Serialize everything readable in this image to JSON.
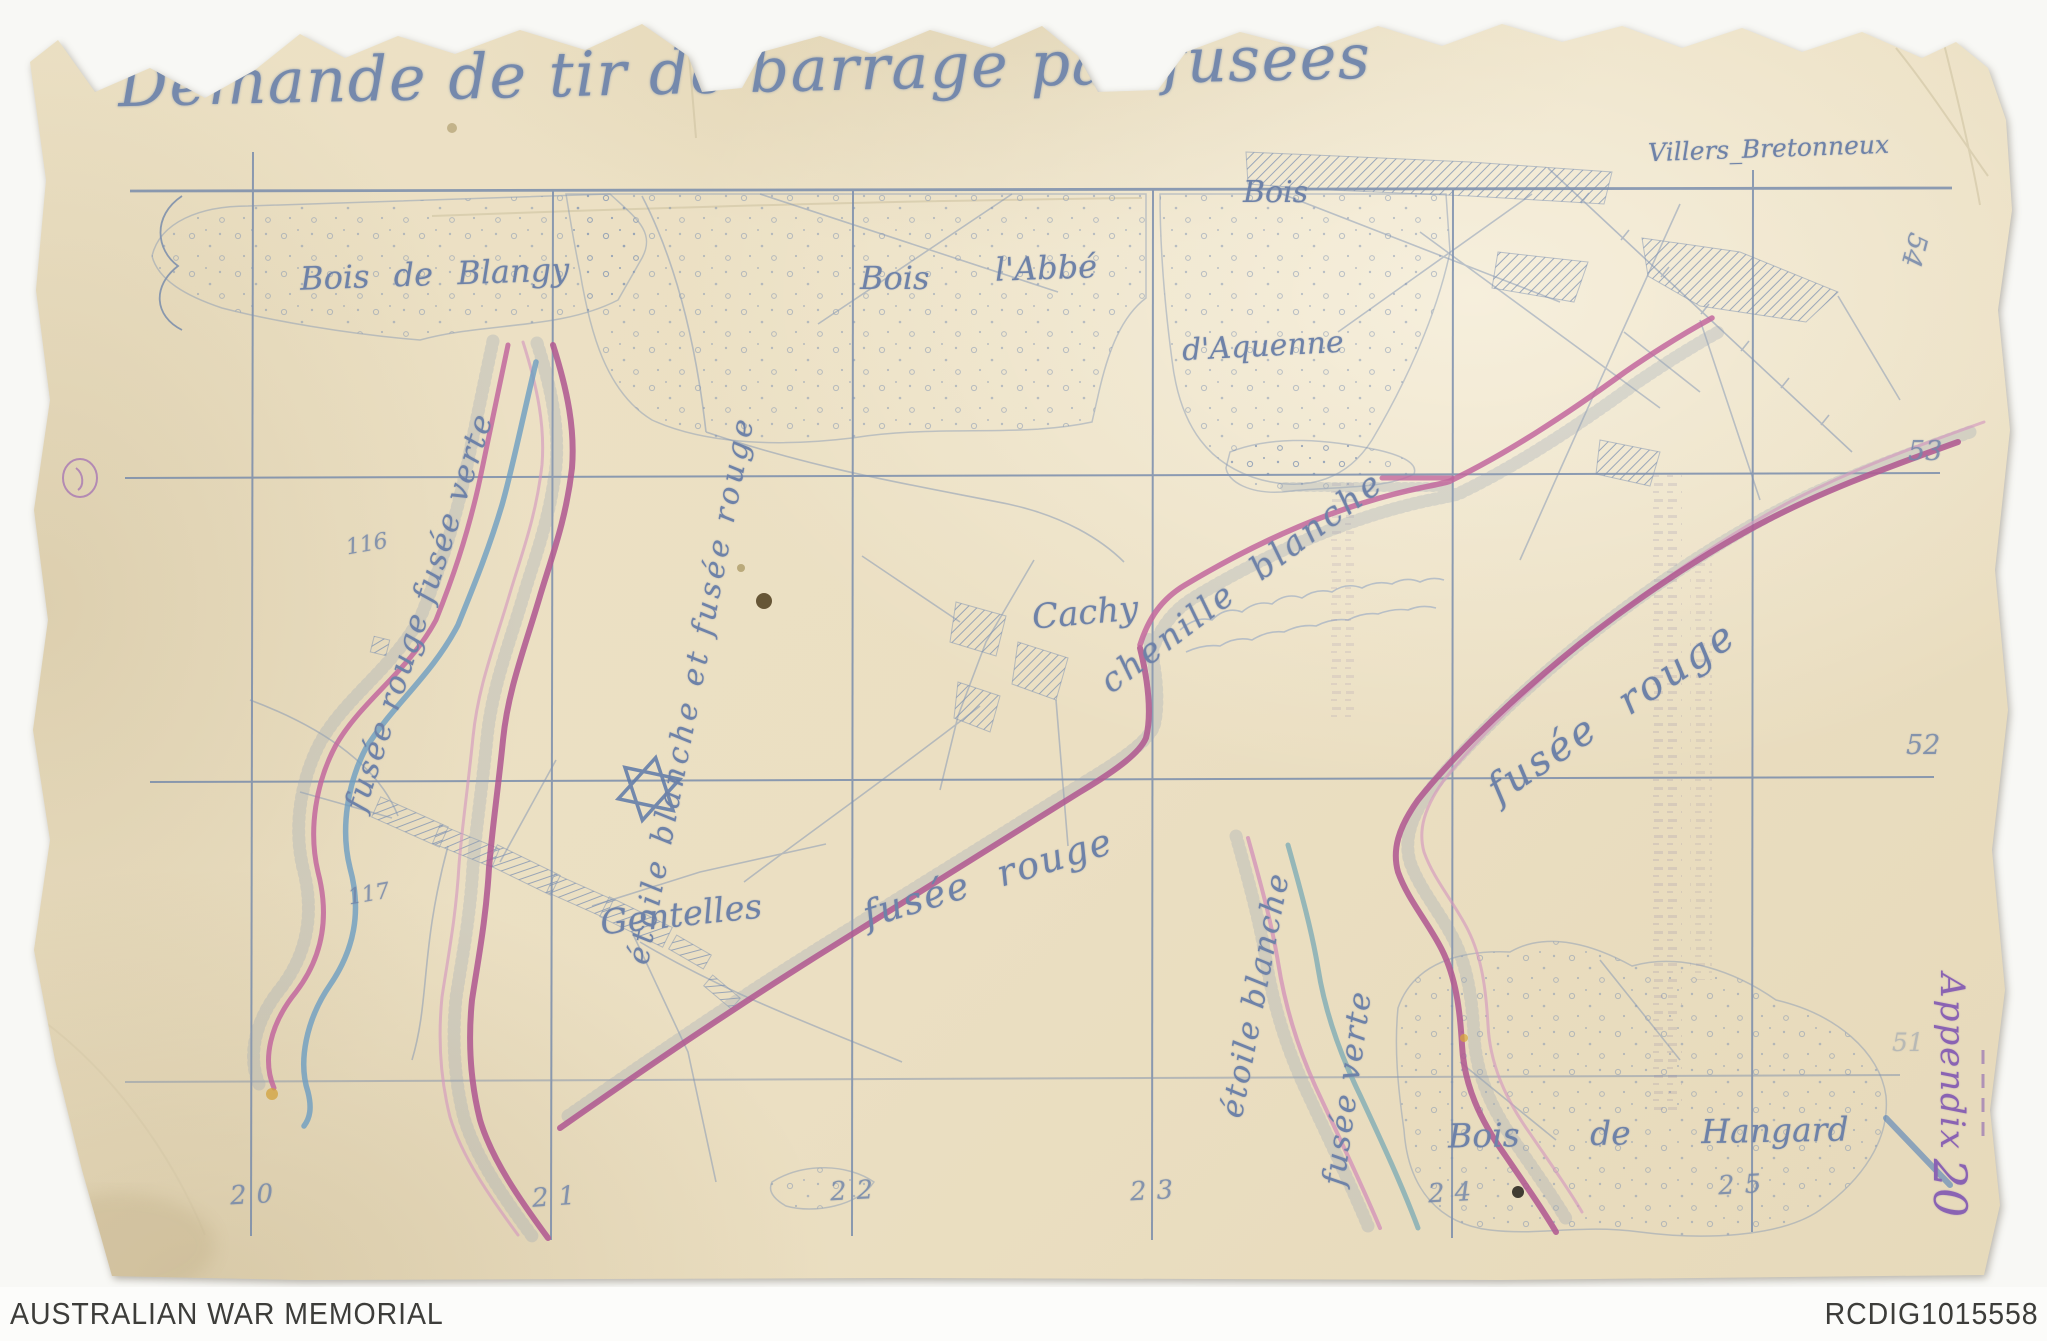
{
  "document": {
    "title": "Demande de tir de barrage par fusées",
    "archive_stamp": {
      "word": "Appendix",
      "number": "20"
    }
  },
  "map": {
    "places": {
      "villers_bretonneux": "Villers_Bretonneux",
      "bois_de_blangy": "Bois de Blangy",
      "bois_labbe_word1": "Bois",
      "bois_labbe_word2": "l'Abbé",
      "bois_daquenne_word1": "Bois",
      "bois_daquenne_word2": "d'Aquenne",
      "cachy": "Cachy",
      "gentelles": "Gentelles",
      "bois_de_hangard": "Bois de Hangard"
    },
    "barrage_labels": {
      "left": "fusée rouge fusée verte",
      "center_left": "étoile blanche et fusée rouge",
      "center": "fusée rouge",
      "caterpillar": "chenille blanche",
      "right": "fusée rouge",
      "south_star": "étoile blanche",
      "south_green": "fusée verte"
    },
    "symbols": {
      "signal_star": "star-of-david"
    },
    "grid_labels": {
      "right": [
        "53",
        "52",
        "51"
      ],
      "rotated_top_right": "54",
      "bottom": [
        "20",
        "21",
        "22",
        "23",
        "24",
        "25"
      ]
    },
    "point_numbers": [
      "116",
      "117"
    ]
  },
  "footer": {
    "institution": "AUSTRALIAN WAR MEMORIAL",
    "reference_id": "RCDIG1015558"
  },
  "colors": {
    "paper": "#ece1c5",
    "ink_blue": "#7287aa",
    "pencil_pink": "#b05a92",
    "pencil_blue": "#6d9ec2",
    "pencil_teal": "#7fadb5",
    "stamp_purple": "#8a63b3"
  }
}
